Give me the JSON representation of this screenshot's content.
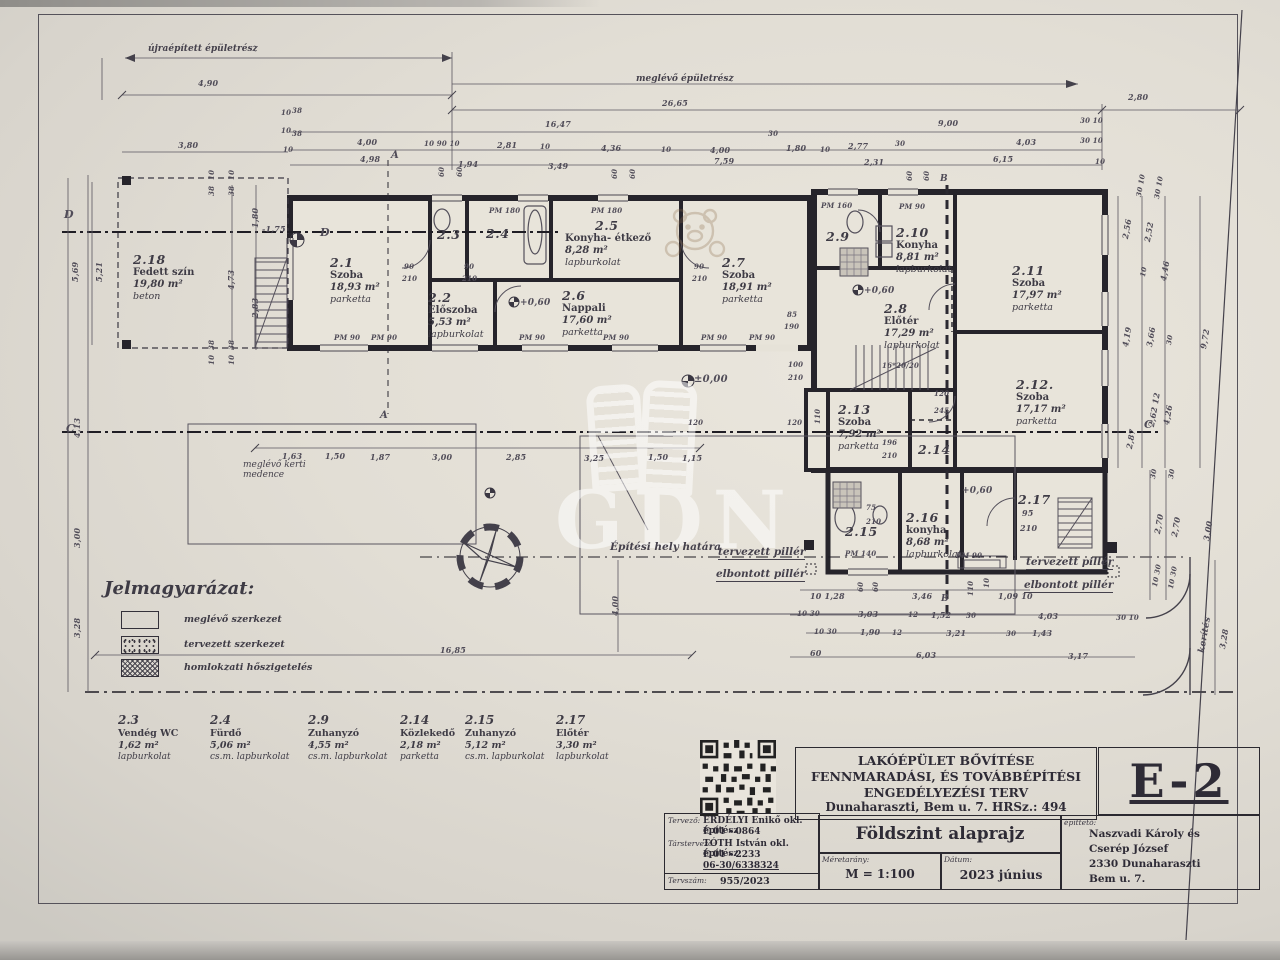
{
  "watermark": {
    "text": "GDN"
  },
  "annotations": {
    "rebuilt_part": "újraépített épületrész",
    "existing_part": "meglévő épületrész",
    "pool": "meglévő kerti medence",
    "site_boundary": "Építési hely határa",
    "planned_pillar": "tervezett pillér",
    "demolished_pillar": "elbontott pillér"
  },
  "legend": {
    "title": "Jelmagyarázat:",
    "items": [
      {
        "label": "meglévő szerkezet"
      },
      {
        "label": "tervezett szerkezet"
      },
      {
        "label": "homlokzati hőszigetelés"
      }
    ]
  },
  "rooms": {
    "r21": {
      "id": "2.1",
      "name": "Szoba",
      "area": "18,93 m²",
      "finish": "parketta"
    },
    "r22": {
      "id": "2.2",
      "name": "Előszoba",
      "area": "5,53 m²",
      "finish": "lapburkolat"
    },
    "r23": {
      "id": "2.3"
    },
    "r24": {
      "id": "2.4"
    },
    "r25": {
      "id": "2.5",
      "name": "Konyha- étkező",
      "area": "8,28 m²",
      "finish": "lapburkolat"
    },
    "r26": {
      "id": "2.6",
      "name": "Nappali",
      "area": "17,60 m²",
      "finish": "parketta"
    },
    "r27": {
      "id": "2.7",
      "name": "Szoba",
      "area": "18,91 m²",
      "finish": "parketta"
    },
    "r28": {
      "id": "2.8",
      "name": "Előtér",
      "area": "17,29 m²",
      "finish": "lapburkolat"
    },
    "r29": {
      "id": "2.9"
    },
    "r210": {
      "id": "2.10",
      "name": "Konyha",
      "area": "8,81 m²",
      "finish": "lapburkolat"
    },
    "r211": {
      "id": "2.11",
      "name": "Szoba",
      "area": "17,97 m²",
      "finish": "parketta"
    },
    "r212": {
      "id": "2.12.",
      "name": "Szoba",
      "area": "17,17 m²",
      "finish": "parketta"
    },
    "r213": {
      "id": "2.13",
      "name": "Szoba",
      "area": "7,92 m²",
      "finish": "parketta"
    },
    "r214": {
      "id": "2.14"
    },
    "r215": {
      "id": "2.15"
    },
    "r216": {
      "id": "2.16",
      "name": "konyha",
      "area": "8,68 m²",
      "finish": "lapburkolat"
    },
    "r217": {
      "id": "2.17"
    },
    "r218": {
      "id": "2.18",
      "name": "Fedett szín",
      "area": "19,80 m²",
      "finish": "beton"
    }
  },
  "schedule": [
    {
      "id": "2.3",
      "name": "Vendég WC",
      "area": "1,62 m²",
      "finish": "lapburkolat"
    },
    {
      "id": "2.4",
      "name": "Fürdő",
      "area": "5,06 m²",
      "finish": "cs.m. lapburkolat"
    },
    {
      "id": "2.9",
      "name": "Zuhanyzó",
      "area": "4,55 m²",
      "finish": "cs.m. lapburkolat"
    },
    {
      "id": "2.14",
      "name": "Közlekedő",
      "area": "2,18 m²",
      "finish": "parketta"
    },
    {
      "id": "2.15",
      "name": "Zuhanyzó",
      "area": "5,12 m²",
      "finish": "cs.m. lapburkolat"
    },
    {
      "id": "2.17",
      "name": "Előtér",
      "area": "3,30 m²",
      "finish": "lapburkolat"
    }
  ],
  "title_block": {
    "project_line1": "LAKÓÉPÜLET BŐVÍTÉSE",
    "project_line2": "FENNMARADÁSI, ÉS TOVÁBBÉPÍTÉSI",
    "project_line3": "ENGEDÉLYEZÉSI TERV",
    "project_line4": "Dunaharaszti, Bem u. 7. HRSz.: 494",
    "sheet_code": "E-2",
    "designer_label": "Tervező:",
    "designer_name": "ERDÉLYI Enikő okl. építész",
    "designer_reg": "É 01 - 0864",
    "co_designer_label": "Társtervező:",
    "co_designer_name": "TÓTH István okl. építész",
    "co_designer_reg": "É 01 - 2233",
    "co_designer_phone": "06-30/6338324",
    "plan_no_label": "Tervszám:",
    "plan_no": "955/2023",
    "drawing_title": "Földszint alaprajz",
    "scale_label": "Méretarány:",
    "scale": "M = 1:100",
    "date_label": "Dátum:",
    "date": "2023 június",
    "client_label": "építtető:",
    "client_name1": "Naszvadi Károly és",
    "client_name2": "Cserép József",
    "client_addr1": "2330 Dunaharaszti",
    "client_addr2": "Bem u. 7."
  },
  "dim_labels": [
    {
      "t": "4,90",
      "x": 198,
      "y": 78
    },
    {
      "t": "26,65",
      "x": 662,
      "y": 98
    },
    {
      "t": "2,80",
      "x": 1128,
      "y": 92
    },
    {
      "t": "16,47",
      "x": 545,
      "y": 119
    },
    {
      "t": "9,00",
      "x": 938,
      "y": 118
    },
    {
      "t": "3,80",
      "x": 178,
      "y": 140
    },
    {
      "t": "10",
      "x": 281,
      "y": 108,
      "s": 7
    },
    {
      "t": "38",
      "x": 292,
      "y": 106,
      "s": 7
    },
    {
      "t": "10",
      "x": 281,
      "y": 126,
      "s": 7
    },
    {
      "t": "38",
      "x": 292,
      "y": 129,
      "s": 7
    },
    {
      "t": "10",
      "x": 283,
      "y": 145,
      "s": 7
    },
    {
      "t": "4,00",
      "x": 357,
      "y": 137
    },
    {
      "t": "10 90 10",
      "x": 424,
      "y": 139,
      "s": 7
    },
    {
      "t": "2,81",
      "x": 497,
      "y": 140
    },
    {
      "t": "10",
      "x": 540,
      "y": 142,
      "s": 7
    },
    {
      "t": "4,36",
      "x": 601,
      "y": 143
    },
    {
      "t": "10",
      "x": 661,
      "y": 145,
      "s": 7
    },
    {
      "t": "4,00",
      "x": 710,
      "y": 145
    },
    {
      "t": "30",
      "x": 768,
      "y": 129,
      "s": 7
    },
    {
      "t": "1,80",
      "x": 786,
      "y": 143
    },
    {
      "t": "10",
      "x": 820,
      "y": 145,
      "s": 7
    },
    {
      "t": "2,77",
      "x": 848,
      "y": 141
    },
    {
      "t": "30",
      "x": 895,
      "y": 139,
      "s": 7
    },
    {
      "t": "4,03",
      "x": 1016,
      "y": 137
    },
    {
      "t": "30 10",
      "x": 1080,
      "y": 116,
      "s": 7
    },
    {
      "t": "30 10",
      "x": 1080,
      "y": 136,
      "s": 7
    },
    {
      "t": "4,98",
      "x": 360,
      "y": 154
    },
    {
      "t": "1,94",
      "x": 458,
      "y": 159
    },
    {
      "t": "3,49",
      "x": 548,
      "y": 161
    },
    {
      "t": "7,59",
      "x": 714,
      "y": 156
    },
    {
      "t": "2,31",
      "x": 864,
      "y": 157
    },
    {
      "t": "6,15",
      "x": 993,
      "y": 154
    },
    {
      "t": "10",
      "x": 1095,
      "y": 157,
      "s": 7
    },
    {
      "t": "60",
      "x": 437,
      "y": 177,
      "r": -90,
      "s": 7
    },
    {
      "t": "60",
      "x": 455,
      "y": 177,
      "r": -90,
      "s": 7
    },
    {
      "t": "60",
      "x": 610,
      "y": 179,
      "r": -90,
      "s": 7
    },
    {
      "t": "60",
      "x": 628,
      "y": 179,
      "r": -90,
      "s": 7
    },
    {
      "t": "60",
      "x": 905,
      "y": 181,
      "r": -90,
      "s": 7
    },
    {
      "t": "60",
      "x": 922,
      "y": 181,
      "r": -90,
      "s": 7
    },
    {
      "t": "B",
      "x": 940,
      "y": 174,
      "s": 9
    },
    {
      "t": "5,69",
      "x": 70,
      "y": 282,
      "r": -90
    },
    {
      "t": "5,21",
      "x": 94,
      "y": 282,
      "r": -90
    },
    {
      "t": "4,13",
      "x": 72,
      "y": 438,
      "r": -90
    },
    {
      "t": "3,00",
      "x": 72,
      "y": 548,
      "r": -90
    },
    {
      "t": "3,28",
      "x": 72,
      "y": 638,
      "r": -90
    },
    {
      "t": "1,80",
      "x": 250,
      "y": 228,
      "r": -90
    },
    {
      "t": "4,73",
      "x": 226,
      "y": 290,
      "r": -90
    },
    {
      "t": "2,83",
      "x": 250,
      "y": 318,
      "r": -90
    },
    {
      "t": "38",
      "x": 207,
      "y": 196,
      "r": -90,
      "s": 7
    },
    {
      "t": "10",
      "x": 207,
      "y": 180,
      "r": -90,
      "s": 7
    },
    {
      "t": "38",
      "x": 227,
      "y": 196,
      "r": -90,
      "s": 7
    },
    {
      "t": "10",
      "x": 227,
      "y": 180,
      "r": -90,
      "s": 7
    },
    {
      "t": "38",
      "x": 207,
      "y": 350,
      "r": -90,
      "s": 7
    },
    {
      "t": "10",
      "x": 207,
      "y": 365,
      "r": -90,
      "s": 7
    },
    {
      "t": "38",
      "x": 227,
      "y": 350,
      "r": -90,
      "s": 7
    },
    {
      "t": "10",
      "x": 227,
      "y": 365,
      "r": -90,
      "s": 7
    },
    {
      "t": "-1,75",
      "x": 262,
      "y": 224
    },
    {
      "t": "D",
      "x": 320,
      "y": 226,
      "s": 11
    },
    {
      "t": "D",
      "x": 64,
      "y": 208,
      "s": 11
    },
    {
      "t": "C",
      "x": 66,
      "y": 422,
      "s": 11
    },
    {
      "t": "A",
      "x": 380,
      "y": 410,
      "s": 10
    },
    {
      "t": "A",
      "x": 391,
      "y": 150,
      "s": 10
    },
    {
      "t": "90",
      "x": 404,
      "y": 262,
      "s": 7
    },
    {
      "t": "210",
      "x": 402,
      "y": 274,
      "s": 7
    },
    {
      "t": "90",
      "x": 464,
      "y": 262,
      "s": 7
    },
    {
      "t": "210",
      "x": 462,
      "y": 274,
      "s": 7
    },
    {
      "t": "90",
      "x": 694,
      "y": 262,
      "s": 7
    },
    {
      "t": "210",
      "x": 692,
      "y": 274,
      "s": 7
    },
    {
      "t": "PM 180",
      "x": 489,
      "y": 206,
      "s": 7
    },
    {
      "t": "PM 180",
      "x": 591,
      "y": 206,
      "s": 7
    },
    {
      "t": "PM 160",
      "x": 821,
      "y": 201,
      "s": 7
    },
    {
      "t": "PM 90",
      "x": 899,
      "y": 202,
      "s": 7
    },
    {
      "t": "PM 90",
      "x": 334,
      "y": 333,
      "s": 7
    },
    {
      "t": "PM 90",
      "x": 371,
      "y": 333,
      "s": 7
    },
    {
      "t": "PM 90",
      "x": 519,
      "y": 333,
      "s": 7
    },
    {
      "t": "PM 90",
      "x": 603,
      "y": 333,
      "s": 7
    },
    {
      "t": "PM 90",
      "x": 701,
      "y": 333,
      "s": 7
    },
    {
      "t": "PM 90",
      "x": 749,
      "y": 333,
      "s": 7
    },
    {
      "t": "85",
      "x": 787,
      "y": 310,
      "s": 7
    },
    {
      "t": "190",
      "x": 784,
      "y": 322,
      "s": 7
    },
    {
      "t": "±0,00",
      "x": 694,
      "y": 374,
      "s": 10
    },
    {
      "t": "+0,60",
      "x": 520,
      "y": 298,
      "s": 9
    },
    {
      "t": "+0,60",
      "x": 864,
      "y": 286,
      "s": 9
    },
    {
      "t": "+0,60",
      "x": 962,
      "y": 486,
      "s": 9
    },
    {
      "t": "100",
      "x": 788,
      "y": 360,
      "s": 7
    },
    {
      "t": "210",
      "x": 788,
      "y": 373,
      "s": 7
    },
    {
      "t": "120",
      "x": 787,
      "y": 418,
      "s": 7
    },
    {
      "t": "110",
      "x": 813,
      "y": 424,
      "r": -90,
      "s": 7
    },
    {
      "t": "16*20/20",
      "x": 882,
      "y": 361,
      "s": 7
    },
    {
      "t": "120",
      "x": 934,
      "y": 389,
      "s": 7
    },
    {
      "t": "245",
      "x": 934,
      "y": 406,
      "s": 7
    },
    {
      "t": "196",
      "x": 882,
      "y": 438,
      "s": 7
    },
    {
      "t": "210",
      "x": 882,
      "y": 451,
      "s": 7
    },
    {
      "t": "75",
      "x": 866,
      "y": 503,
      "s": 7
    },
    {
      "t": "210",
      "x": 866,
      "y": 517,
      "s": 7
    },
    {
      "t": "95",
      "x": 1022,
      "y": 508,
      "s": 8
    },
    {
      "t": "210",
      "x": 1020,
      "y": 523,
      "s": 8
    },
    {
      "t": "PM 140",
      "x": 845,
      "y": 549,
      "s": 7
    },
    {
      "t": "PM 90",
      "x": 956,
      "y": 551,
      "s": 7
    },
    {
      "t": "2,56",
      "x": 1120,
      "y": 238,
      "r": -80
    },
    {
      "t": "2,52",
      "x": 1142,
      "y": 241,
      "r": -80
    },
    {
      "t": "10",
      "x": 1138,
      "y": 276,
      "r": -80,
      "s": 7
    },
    {
      "t": "4,46",
      "x": 1158,
      "y": 280,
      "r": -80
    },
    {
      "t": "30 10",
      "x": 1134,
      "y": 196,
      "r": -80,
      "s": 7
    },
    {
      "t": "30 10",
      "x": 1152,
      "y": 198,
      "r": -80,
      "s": 7
    },
    {
      "t": "4,19",
      "x": 1120,
      "y": 346,
      "r": -80
    },
    {
      "t": "3,66",
      "x": 1144,
      "y": 346,
      "r": -80
    },
    {
      "t": "30",
      "x": 1164,
      "y": 344,
      "r": -80,
      "s": 7
    },
    {
      "t": "9,72",
      "x": 1198,
      "y": 348,
      "r": -80
    },
    {
      "t": "2,87",
      "x": 1124,
      "y": 448,
      "r": -80
    },
    {
      "t": "2,62 12",
      "x": 1146,
      "y": 426,
      "r": -80
    },
    {
      "t": "4,26",
      "x": 1161,
      "y": 424,
      "r": -80
    },
    {
      "t": "C",
      "x": 1144,
      "y": 418,
      "s": 11
    },
    {
      "t": "30",
      "x": 1148,
      "y": 478,
      "r": -80,
      "s": 7
    },
    {
      "t": "30",
      "x": 1166,
      "y": 478,
      "r": -80,
      "s": 7
    },
    {
      "t": "2,70",
      "x": 1152,
      "y": 533,
      "r": -80
    },
    {
      "t": "2,70",
      "x": 1169,
      "y": 536,
      "r": -80
    },
    {
      "t": "3,00",
      "x": 1201,
      "y": 540,
      "r": -80
    },
    {
      "t": "10 30",
      "x": 1150,
      "y": 586,
      "r": -80,
      "s": 7
    },
    {
      "t": "10 30",
      "x": 1166,
      "y": 588,
      "r": -80,
      "s": 7
    },
    {
      "t": "kerítés",
      "x": 1197,
      "y": 652,
      "r": -80,
      "s": 9
    },
    {
      "t": "3,28",
      "x": 1217,
      "y": 648,
      "r": -80
    },
    {
      "t": "1,63",
      "x": 282,
      "y": 451
    },
    {
      "t": "1,50",
      "x": 325,
      "y": 451
    },
    {
      "t": "1,87",
      "x": 370,
      "y": 452
    },
    {
      "t": "3,00",
      "x": 432,
      "y": 452
    },
    {
      "t": "2,85",
      "x": 506,
      "y": 452
    },
    {
      "t": "3,25",
      "x": 584,
      "y": 453
    },
    {
      "t": "1,50",
      "x": 648,
      "y": 452
    },
    {
      "t": "1,15",
      "x": 682,
      "y": 453
    },
    {
      "t": "120",
      "x": 688,
      "y": 418,
      "s": 7
    },
    {
      "t": "16,85",
      "x": 440,
      "y": 645
    },
    {
      "t": "4,00",
      "x": 610,
      "y": 616,
      "r": -90
    },
    {
      "t": "10  1,28",
      "x": 810,
      "y": 591
    },
    {
      "t": "60",
      "x": 856,
      "y": 592,
      "r": -90,
      "s": 7
    },
    {
      "t": "60",
      "x": 871,
      "y": 592,
      "r": -90,
      "s": 7
    },
    {
      "t": "3,46",
      "x": 912,
      "y": 591
    },
    {
      "t": "110",
      "x": 966,
      "y": 596,
      "r": -90,
      "s": 7
    },
    {
      "t": "10",
      "x": 982,
      "y": 588,
      "r": -90,
      "s": 7
    },
    {
      "t": "1,09 10",
      "x": 998,
      "y": 591
    },
    {
      "t": "B",
      "x": 941,
      "y": 594,
      "s": 9
    },
    {
      "t": "10 30",
      "x": 797,
      "y": 609,
      "s": 7
    },
    {
      "t": "3,03",
      "x": 858,
      "y": 609
    },
    {
      "t": "12",
      "x": 908,
      "y": 610,
      "s": 7
    },
    {
      "t": "1,52",
      "x": 931,
      "y": 610
    },
    {
      "t": "30",
      "x": 966,
      "y": 611,
      "s": 7
    },
    {
      "t": "4,03",
      "x": 1038,
      "y": 611
    },
    {
      "t": "30 10",
      "x": 1116,
      "y": 613,
      "s": 7
    },
    {
      "t": "10 30",
      "x": 814,
      "y": 627,
      "s": 7
    },
    {
      "t": "1,90",
      "x": 860,
      "y": 627
    },
    {
      "t": "12",
      "x": 892,
      "y": 628,
      "s": 7
    },
    {
      "t": "3,21",
      "x": 946,
      "y": 628
    },
    {
      "t": "30",
      "x": 1006,
      "y": 629,
      "s": 7
    },
    {
      "t": "1,43",
      "x": 1032,
      "y": 628
    },
    {
      "t": "60",
      "x": 810,
      "y": 648
    },
    {
      "t": "6,03",
      "x": 916,
      "y": 650
    },
    {
      "t": "3,17",
      "x": 1068,
      "y": 651
    }
  ]
}
